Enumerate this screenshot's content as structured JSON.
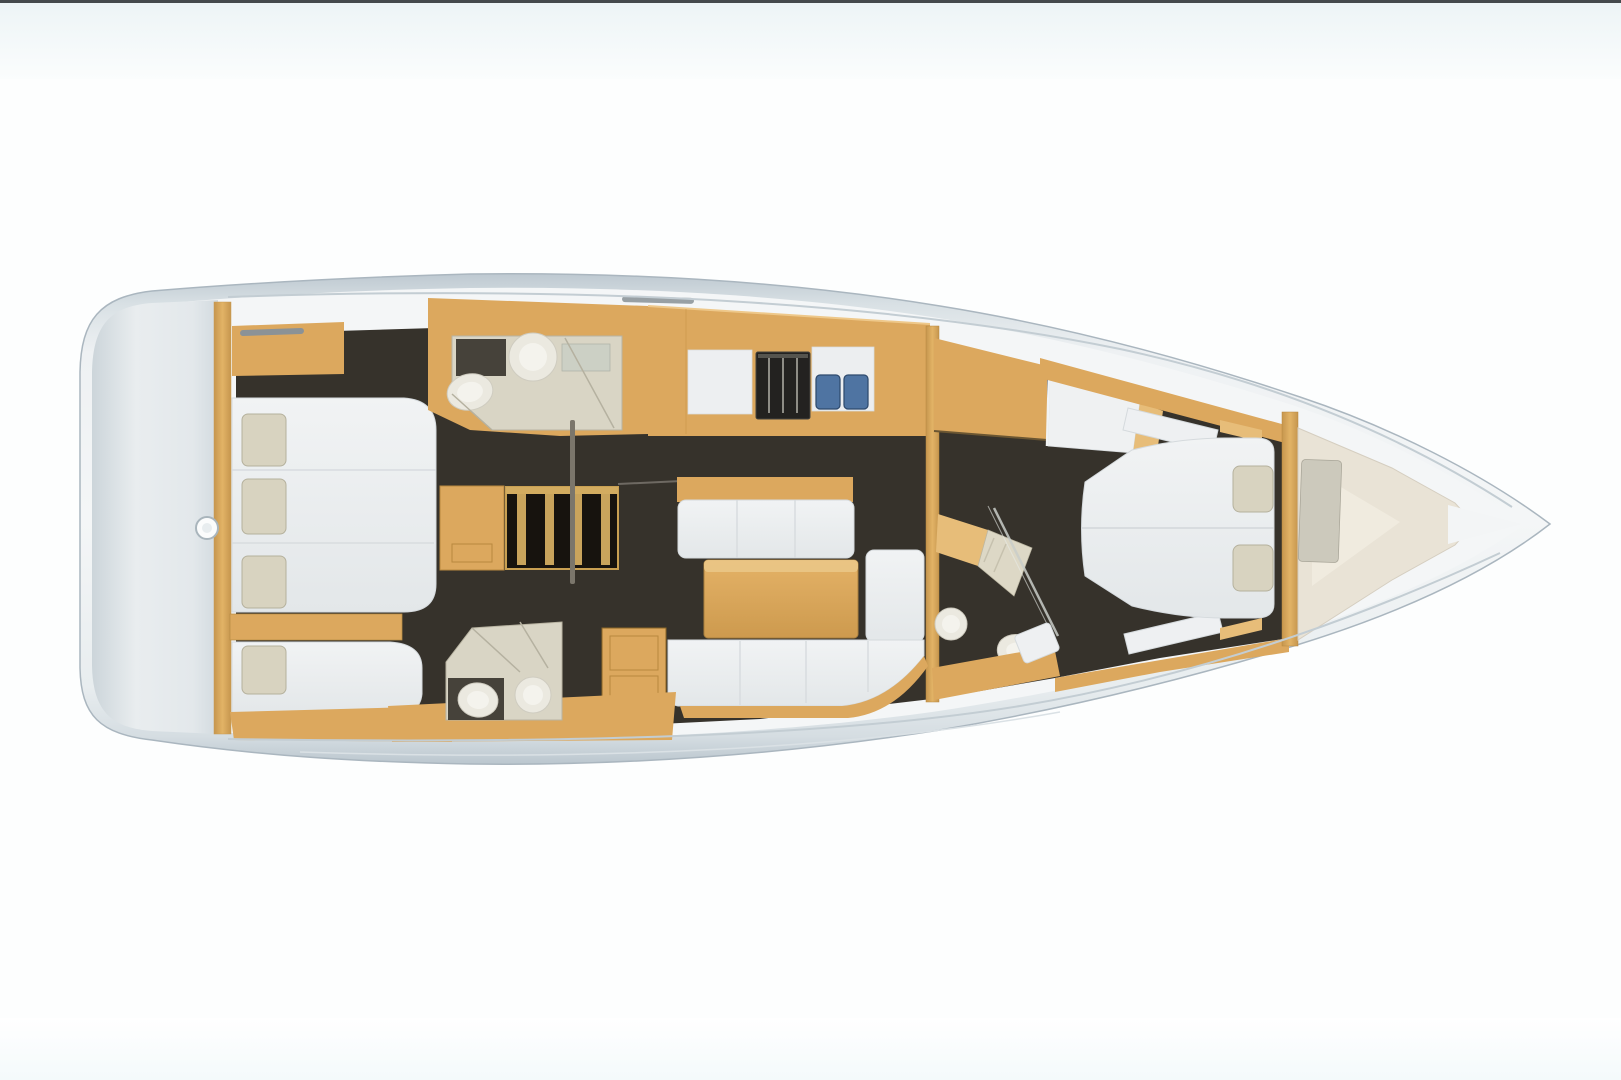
{
  "scene": {
    "title": "Top-down 3D rendering of a sailboat interior layout plan",
    "type": "floor-plan",
    "text_content": "none - image contains no rendered text"
  },
  "colors": {
    "background": "#fdfefe",
    "topline": "#45494c",
    "band_top": "#edf4f6",
    "band_bottom": "#f4fafb",
    "hull_edge": "#aab6bf",
    "deck": "#f4f6f7",
    "floor_dark": "#36322b",
    "wood": "#dca85e",
    "wood_dark": "#b8883f",
    "wood_light": "#e7bd79",
    "cushion": "#eef0f2",
    "cushion_edge": "#d5dadd",
    "pillow": "#d8d3c0",
    "pillow_edge": "#b5b19d",
    "bath_wall": "#d9d5c5",
    "bath_dark": "#46423a",
    "fixture": "#ebe9e0",
    "fixture_edge": "#cfccc0",
    "sink_blue": "#4f74a2",
    "sink_blue_dark": "#2e4a6e",
    "stove_body": "#232220",
    "stove_grate": "#8e8d86",
    "seam": "#c3cdd3",
    "bow_sole": "#e9e3d6",
    "bow_sole_light": "#f0ebdf",
    "locker_gray": "#ccc9bc"
  },
  "regions": [
    {
      "id": "stern-platform",
      "label": "stern swim platform / transom"
    },
    {
      "id": "aft-cabin-starboard",
      "label": "starboard aft cabin with double berth"
    },
    {
      "id": "aft-cabin-port",
      "label": "port aft cabin with berth"
    },
    {
      "id": "head-aft-starboard",
      "label": "starboard aft head with sink and toilet"
    },
    {
      "id": "head-aft-port",
      "label": "port aft head with sink and toilet"
    },
    {
      "id": "galley",
      "label": "galley with stove and double sink"
    },
    {
      "id": "companionway",
      "label": "companionway stairs"
    },
    {
      "id": "salon",
      "label": "salon with settees and table"
    },
    {
      "id": "head-forward",
      "label": "forward head with shower bench, sink and toilet"
    },
    {
      "id": "forward-cabin",
      "label": "forward cabin with island berth"
    },
    {
      "id": "forepeak",
      "label": "forepeak / sail locker"
    },
    {
      "id": "bow",
      "label": "bow"
    }
  ]
}
